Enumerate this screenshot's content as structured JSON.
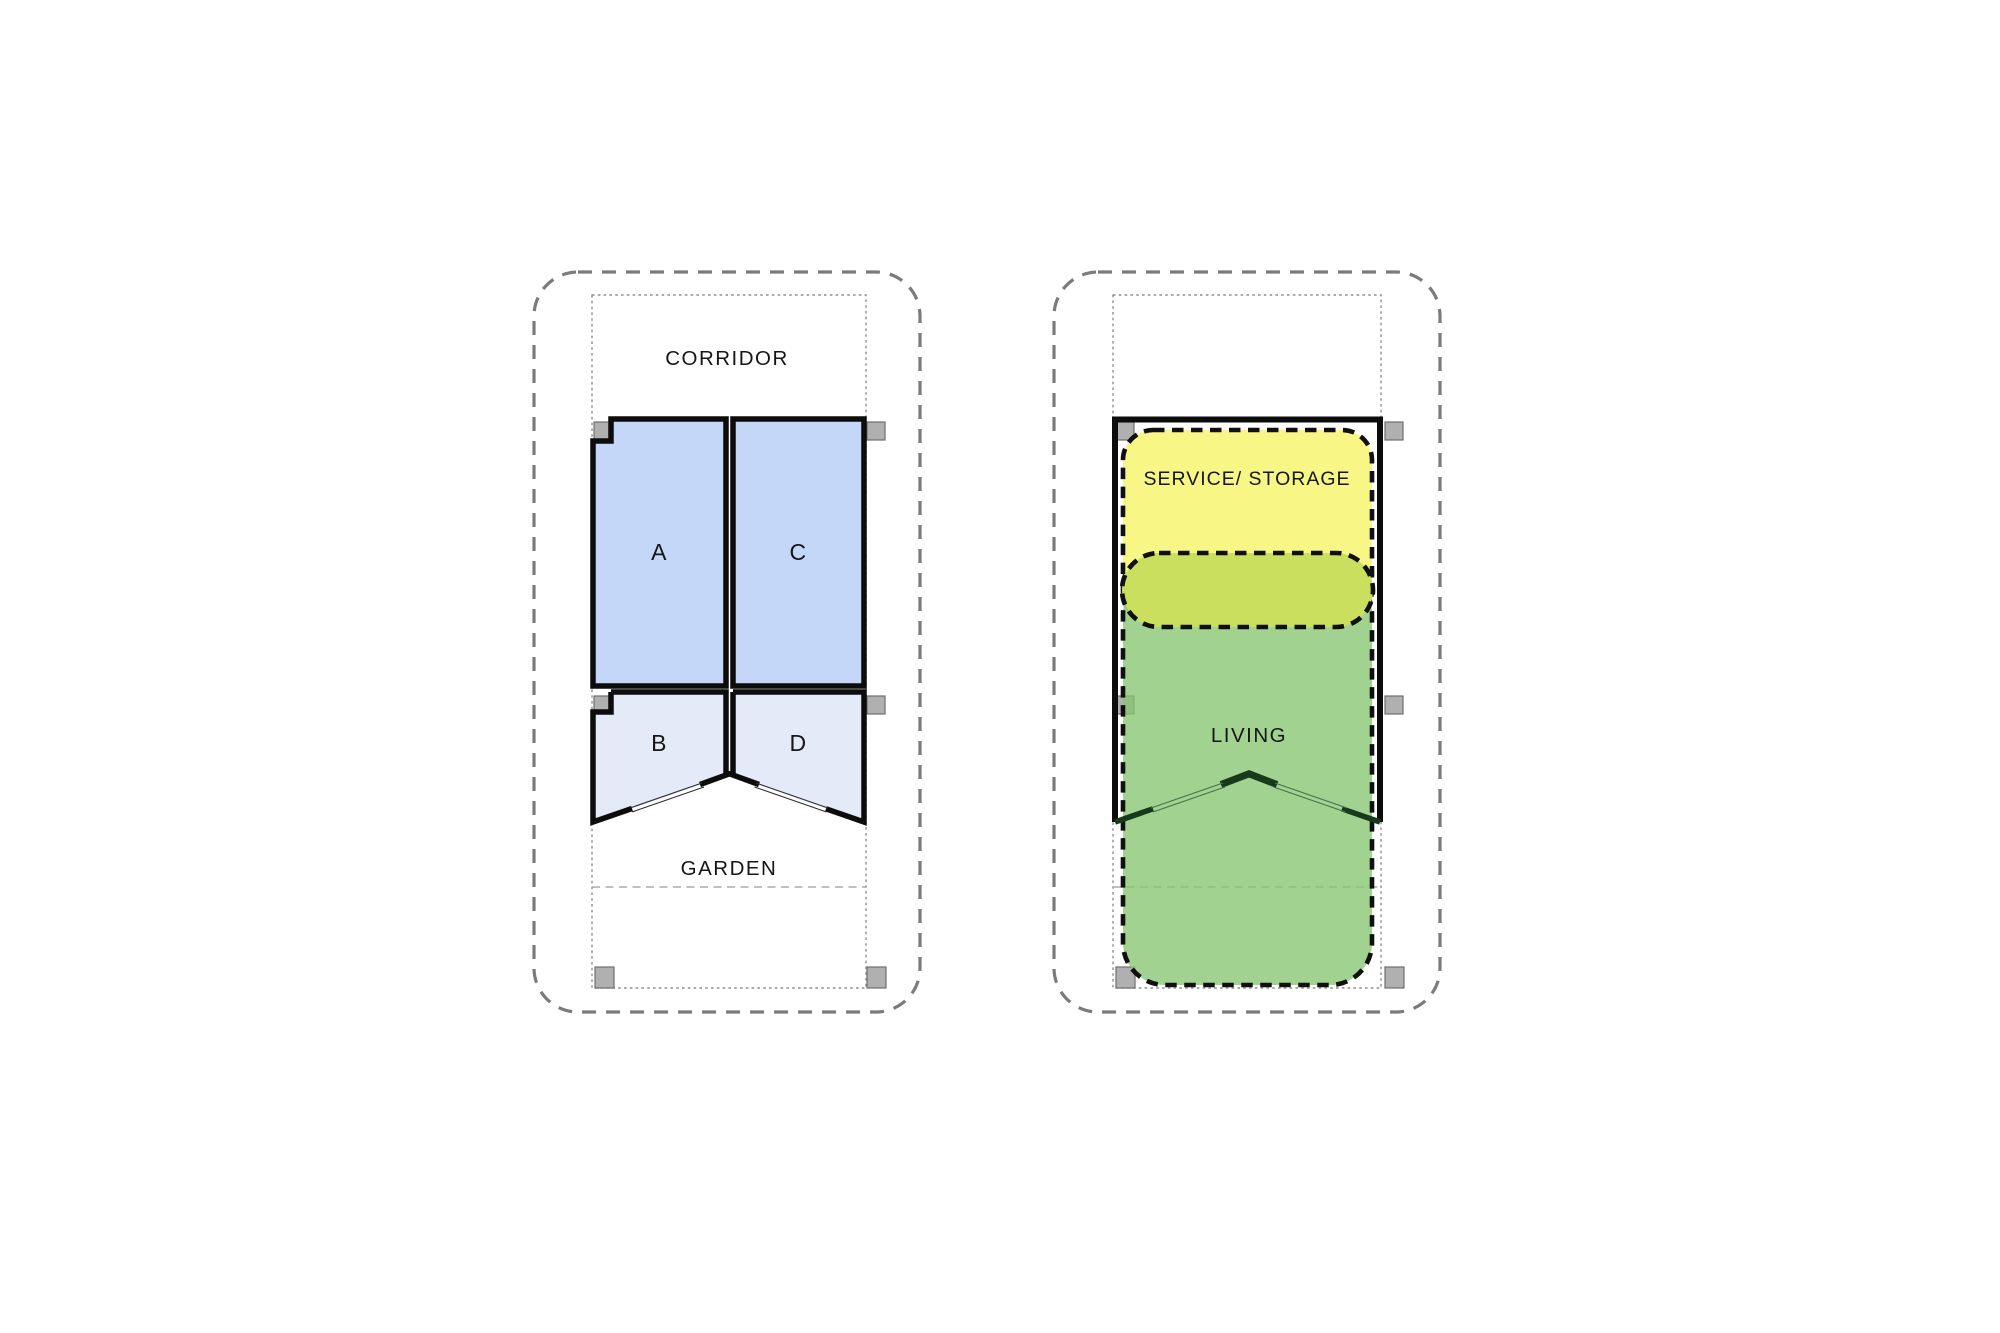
{
  "diagram": {
    "left_plan": {
      "corridor_label": "CORRIDOR",
      "garden_label": "GARDEN",
      "rooms": [
        {
          "label": "A"
        },
        {
          "label": "B"
        },
        {
          "label": "C"
        },
        {
          "label": "D"
        }
      ]
    },
    "right_plan": {
      "service_label": "SERVICE/ STORAGE",
      "living_label": "LIVING"
    },
    "colors": {
      "room_large_fill": "#c4d7f8",
      "room_small_fill": "#e4eaf8",
      "service_zone_fill": "#f8f786",
      "overlap_zone_fill": "#cbdf5e",
      "living_zone_fill": "#88c571",
      "column_fill": "#b0b0b0",
      "wall": "#0c0c0c",
      "site_boundary": "#7b7b7b"
    }
  }
}
